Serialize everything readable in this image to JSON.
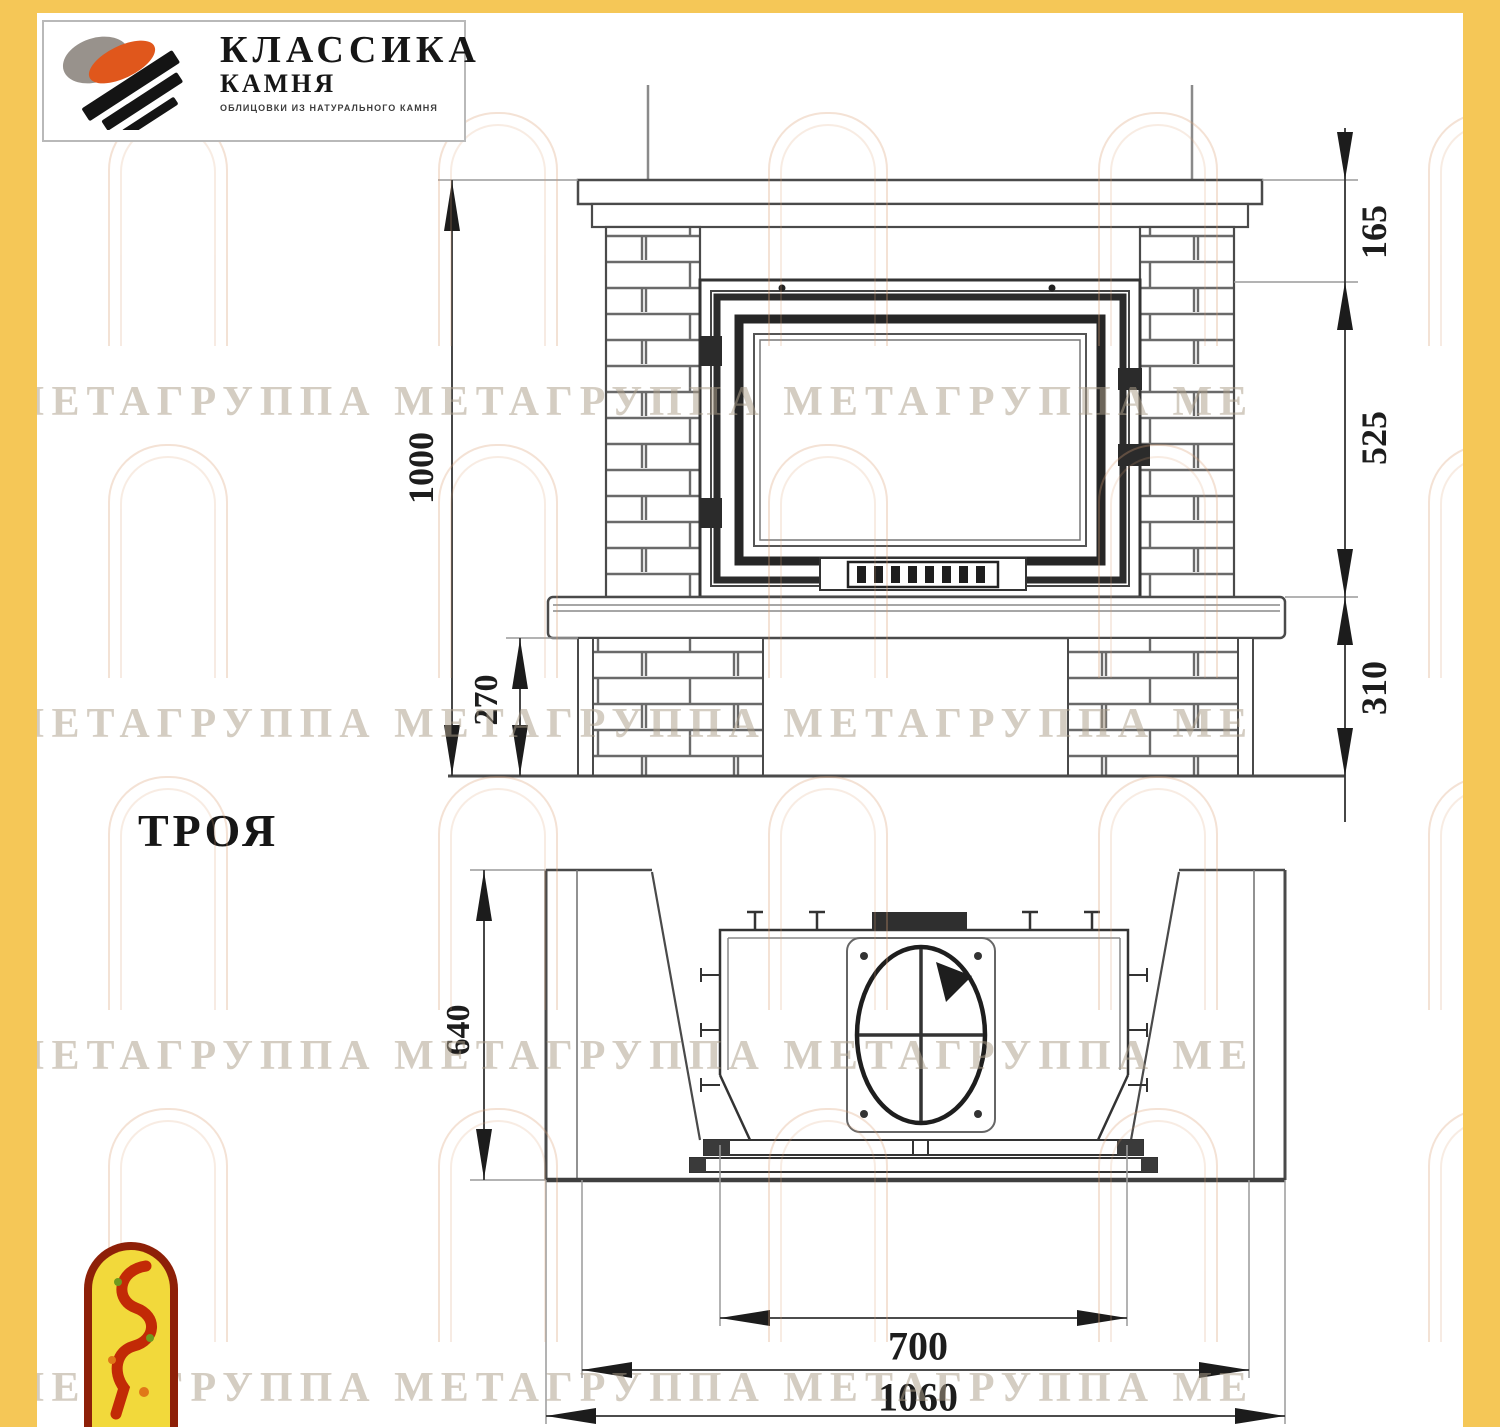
{
  "logo": {
    "line1": "КЛАССИКА",
    "line2": "КАМНЯ",
    "tagline": "ОБЛИЦОВКИ ИЗ НАТУРАЛЬНОГО КАМНЯ"
  },
  "model": {
    "name": "ТРОЯ"
  },
  "watermark": {
    "row_text": "А МЕТАГРУППА МЕТАГРУППА МЕТАГРУППА МЕ"
  },
  "front_view": {
    "dim_total_height": "1000",
    "dim_pedestal_height": "270",
    "dim_shelf_to_insert": "165",
    "dim_insert_height": "525",
    "dim_insert_to_floor": "310"
  },
  "plan_view": {
    "dim_depth": "640",
    "dim_firebox_width": "700",
    "dim_inner_width": "1060",
    "dim_overall_width": "1160"
  },
  "colors": {
    "accent_yellow": "#f5c757",
    "emblem_red": "#8e2008",
    "emblem_yellow": "#f2d93b",
    "logo_orange": "#e0571c"
  }
}
